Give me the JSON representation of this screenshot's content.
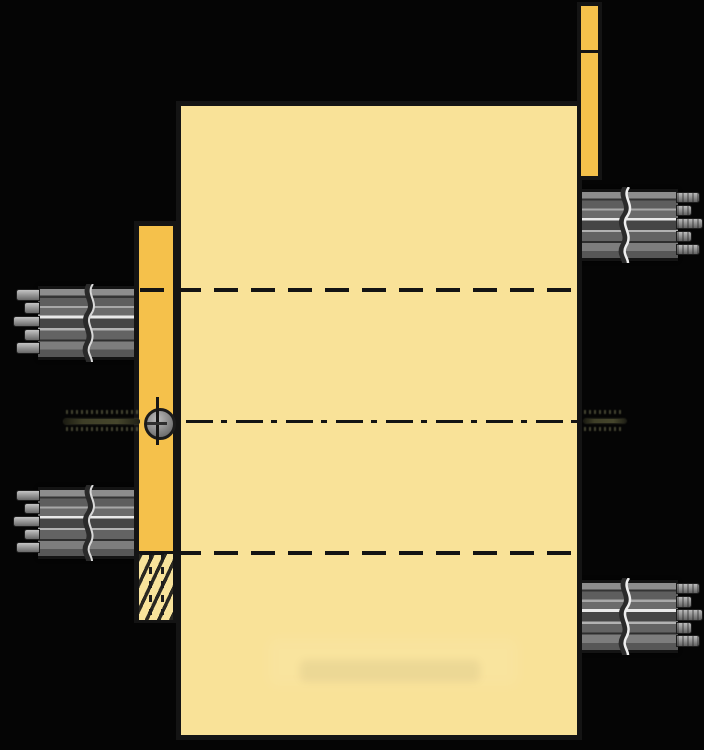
{
  "palette": {
    "background": "#050505",
    "outline": "#141414",
    "housing_fill": "#F9E298",
    "flange_fill": "#F5C14B",
    "hatch_fill": "#F8E39B",
    "shaft_dark": "#343434",
    "shaft_mid": "#6b6b6b",
    "shaft_light": "#a8a8a8",
    "shaft_highlight": "#e9e9e9",
    "teeth_light": "#c4c4c4",
    "pin_olive": "#3e3e27",
    "bolt_gray": "#848484"
  },
  "components": {
    "housing_body": "main-housing-plate",
    "left_flange": "left-mounting-flange",
    "left_flange_hatch": "sectioned-fastener-hatch",
    "top_right_flange": "upper-right-mounting-flange",
    "shafts": [
      "upper-left-splined-shaft",
      "lower-left-splined-shaft",
      "upper-right-splined-shaft",
      "lower-right-splined-shaft"
    ],
    "centerlines": [
      "upper-gear-axis-dashed",
      "main-axis-dash-dot",
      "lower-gear-axis-dashed"
    ],
    "bolt_symbol": "bolt-head-side-symbol",
    "pins": [
      "left-centerline-pin-stub",
      "right-centerline-pin-stub"
    ]
  },
  "text": {}
}
